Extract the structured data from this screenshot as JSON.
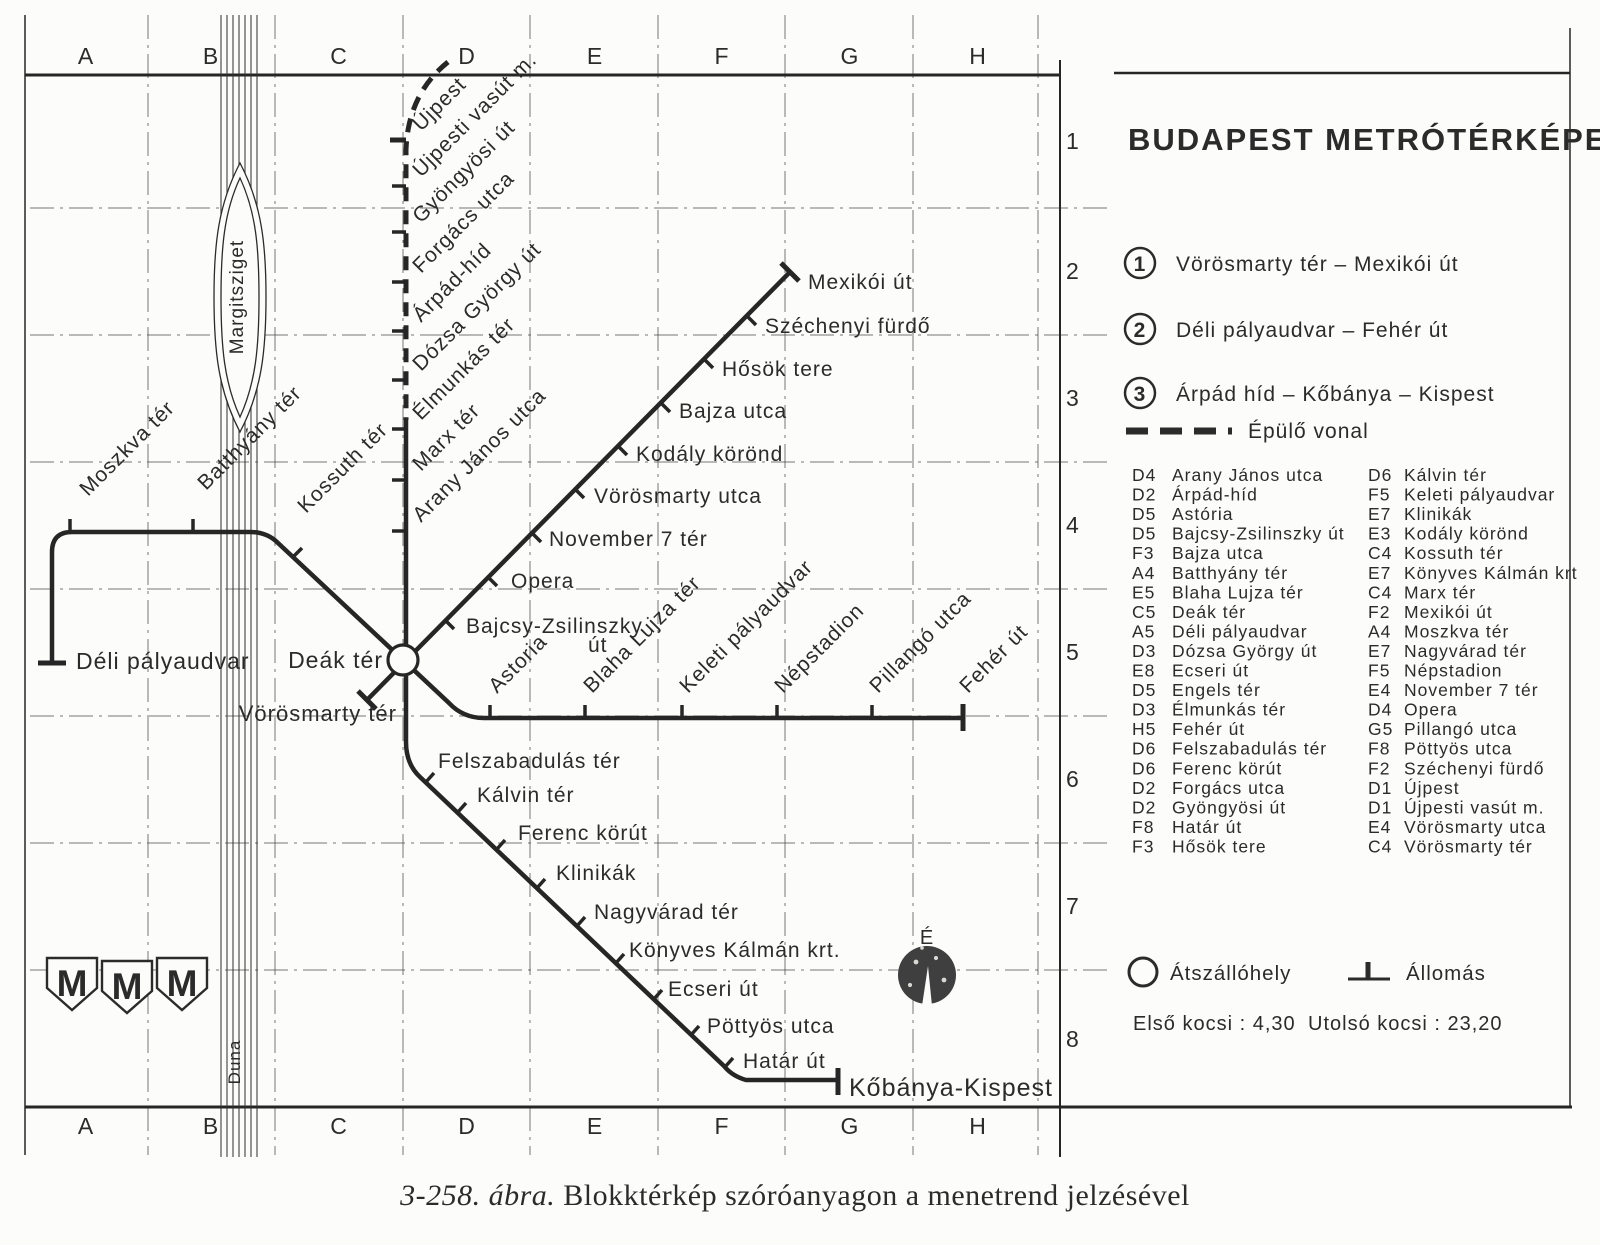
{
  "title": "BUDAPEST METRÓTÉRKÉPE",
  "caption": {
    "prefix": "3-258. ábra.",
    "rest": " Blokktérkép szóróanyagon a menetrend jelzésével"
  },
  "colors": {
    "ink": "#262626",
    "grid": "#4a4a4a",
    "paper": "#fcfcfa"
  },
  "labels": {
    "margitsziget": "Margitsziget",
    "duna": "Duna",
    "north": "É"
  },
  "logo": {
    "letter": "M"
  },
  "legend": {
    "lines": [
      {
        "num": "1",
        "label": "Vörösmarty tér – Mexikói út"
      },
      {
        "num": "2",
        "label": "Déli pályaudvar – Fehér út"
      },
      {
        "num": "3",
        "label": "Árpád híd – Kőbánya – Kispest"
      }
    ],
    "construction_label": "Épülő vonal",
    "interchange_label": "Átszállóhely",
    "station_label": "Állomás",
    "first_car": "Első kocsi : 4,30",
    "last_car": "Utolsó kocsi : 23,20"
  },
  "grid": {
    "cols": [
      {
        "l": "A",
        "x": 86
      },
      {
        "l": "B",
        "x": 211
      },
      {
        "l": "C",
        "x": 339
      },
      {
        "l": "D",
        "x": 467
      },
      {
        "l": "E",
        "x": 595
      },
      {
        "l": "F",
        "x": 722
      },
      {
        "l": "G",
        "x": 850
      },
      {
        "l": "H",
        "x": 978
      }
    ],
    "rows": [
      {
        "n": "1",
        "y": 149
      },
      {
        "n": "2",
        "y": 279
      },
      {
        "n": "3",
        "y": 406
      },
      {
        "n": "4",
        "y": 533
      },
      {
        "n": "5",
        "y": 660
      },
      {
        "n": "6",
        "y": 787
      },
      {
        "n": "7",
        "y": 914
      },
      {
        "n": "8",
        "y": 1047
      }
    ],
    "vlines": [
      148,
      275,
      403,
      530,
      658,
      785,
      913,
      1038
    ],
    "hlines": [
      208,
      335,
      462,
      589,
      716,
      843,
      970
    ],
    "top_letter_y": 64,
    "bottom_letter_y": 1134,
    "row_num_x": 1066
  },
  "frame": {
    "segments": [
      {
        "x1": 25,
        "y1": 75,
        "x2": 1060,
        "y2": 75,
        "w": 3
      },
      {
        "x1": 1114,
        "y1": 73,
        "x2": 1570,
        "y2": 73,
        "w": 2.5
      },
      {
        "x1": 25,
        "y1": 1107,
        "x2": 1572,
        "y2": 1107,
        "w": 3
      },
      {
        "x1": 25,
        "y1": 15,
        "x2": 25,
        "y2": 1155,
        "w": 1.5
      },
      {
        "x1": 1060,
        "y1": 60,
        "x2": 1060,
        "y2": 1157,
        "w": 2
      },
      {
        "x1": 1570,
        "y1": 28,
        "x2": 1570,
        "y2": 1107,
        "w": 1.5
      }
    ]
  },
  "river": {
    "xs": [
      221,
      227,
      233,
      239,
      245,
      251,
      257
    ],
    "y1": 15,
    "y2": 1157
  },
  "map": {
    "routes": [
      {
        "name": "line-3-under-construction",
        "d": "M 448 62 Q 408 94 406 150 L 406 420",
        "w": 5,
        "dash": "14 9"
      },
      {
        "name": "line-3",
        "d": "M 406 420 L 406 742 Q 406 764 420 777 L 724 1066 Q 732 1076 746 1080 L 838 1080",
        "w": 4.5
      },
      {
        "name": "line-2",
        "d": "M 52 662 L 52 552 Q 52 532 72 532 L 250 532 Q 267 532 278 543 L 449 703 Q 463 718 484 718 L 963 718",
        "w": 4.5
      },
      {
        "name": "line-1",
        "d": "M 367 700 L 790 272",
        "w": 4.5
      }
    ],
    "stations": [
      {
        "name": "Újpest",
        "lx": 421,
        "ly": 132,
        "rot": -45,
        "tick": [
          406,
          140,
          390,
          140
        ],
        "tw": 5
      },
      {
        "name": "Újpesti vasút m.",
        "lx": 421,
        "ly": 178,
        "rot": -45,
        "tick": [
          406,
          186,
          392,
          186
        ]
      },
      {
        "name": "Gyöngyösi út",
        "lx": 421,
        "ly": 224,
        "rot": -45,
        "tick": [
          406,
          232,
          392,
          232
        ]
      },
      {
        "name": "Forgács utca",
        "lx": 421,
        "ly": 274,
        "rot": -45,
        "tick": [
          406,
          282,
          392,
          282
        ]
      },
      {
        "name": "Árpád-híd",
        "lx": 421,
        "ly": 323,
        "rot": -45,
        "tick": [
          406,
          331,
          392,
          331
        ]
      },
      {
        "name": "Dózsa György út",
        "lx": 421,
        "ly": 372,
        "rot": -45,
        "tick": [
          406,
          380,
          392,
          380
        ]
      },
      {
        "name": "Élmunkás tér",
        "lx": 421,
        "ly": 421,
        "rot": -45,
        "tick": [
          406,
          429,
          392,
          429
        ]
      },
      {
        "name": "Marx tér",
        "lx": 421,
        "ly": 472,
        "rot": -45,
        "tick": [
          406,
          480,
          392,
          480
        ]
      },
      {
        "name": "Arany János utca",
        "lx": 421,
        "ly": 523,
        "rot": -45,
        "tick": [
          406,
          531,
          392,
          531
        ]
      },
      {
        "name": "Vörösmarty tér",
        "lx": 397,
        "ly": 721,
        "anchor": "end",
        "size": 22,
        "term": [
          358,
          691,
          376,
          709
        ]
      },
      {
        "name": "Bajcsy-Zsilinszky",
        "name2": "út",
        "l2x": 588,
        "l2y": 652,
        "lx": 466,
        "ly": 633,
        "tick": [
          446,
          621,
          454,
          629
        ]
      },
      {
        "name": "Opera",
        "lx": 511,
        "ly": 588,
        "tick": [
          489,
          578,
          497,
          586
        ]
      },
      {
        "name": "November 7 tér",
        "lx": 549,
        "ly": 546,
        "tick": [
          533,
          534,
          541,
          542
        ]
      },
      {
        "name": "Vörösmarty utca",
        "lx": 594,
        "ly": 503,
        "tick": [
          576,
          490,
          584,
          498
        ]
      },
      {
        "name": "Kodály körönd",
        "lx": 636,
        "ly": 461,
        "tick": [
          619,
          447,
          627,
          455
        ]
      },
      {
        "name": "Bajza utca",
        "lx": 679,
        "ly": 418,
        "tick": [
          662,
          404,
          670,
          412
        ]
      },
      {
        "name": "Hősök tere",
        "lx": 722,
        "ly": 376,
        "tick": [
          705,
          360,
          713,
          368
        ]
      },
      {
        "name": "Széchenyi fürdő",
        "lx": 765,
        "ly": 333,
        "tick": [
          748,
          317,
          756,
          325
        ]
      },
      {
        "name": "Mexikói út",
        "lx": 808,
        "ly": 289,
        "term": [
          781,
          263,
          799,
          281
        ]
      },
      {
        "name": "Déli pályaudvar",
        "lx": 76,
        "ly": 669,
        "size": 23,
        "term": [
          38,
          663,
          66,
          663
        ]
      },
      {
        "name": "Moszkva tér",
        "lx": 88,
        "ly": 497,
        "rot": -45,
        "tick": [
          70,
          532,
          70,
          519
        ]
      },
      {
        "name": "Batthyány tér",
        "lx": 206,
        "ly": 491,
        "rot": -45,
        "tick": [
          193,
          532,
          193,
          519
        ]
      },
      {
        "name": "Kossuth tér",
        "lx": 306,
        "ly": 514,
        "rot": -45,
        "tick": [
          293,
          557,
          302,
          548
        ]
      },
      {
        "name": "Deák tér",
        "lx": 383,
        "ly": 668,
        "anchor": "end",
        "size": 23,
        "inter": [
          403,
          660,
          15
        ]
      },
      {
        "name": "Astoria",
        "lx": 497,
        "ly": 694,
        "rot": -45,
        "tick": [
          490,
          718,
          490,
          705
        ]
      },
      {
        "name": "Blaha Lujza tér",
        "lx": 592,
        "ly": 694,
        "rot": -45,
        "tick": [
          585,
          718,
          585,
          705
        ]
      },
      {
        "name": "Keleti pályaudvar",
        "lx": 688,
        "ly": 694,
        "rot": -45,
        "tick": [
          682,
          718,
          682,
          705
        ]
      },
      {
        "name": "Népstadion",
        "lx": 783,
        "ly": 694,
        "rot": -45,
        "tick": [
          777,
          718,
          777,
          705
        ]
      },
      {
        "name": "Pillangó utca",
        "lx": 878,
        "ly": 694,
        "rot": -45,
        "tick": [
          872,
          718,
          872,
          705
        ]
      },
      {
        "name": "Fehér út",
        "lx": 968,
        "ly": 694,
        "rot": -45,
        "term": [
          963,
          704,
          963,
          731
        ]
      },
      {
        "name": "Felszabadulás tér",
        "lx": 438,
        "ly": 768,
        "tick": [
          426,
          782,
          434,
          773
        ]
      },
      {
        "name": "Kálvin tér",
        "lx": 477,
        "ly": 802,
        "tick": [
          458,
          812,
          466,
          803
        ]
      },
      {
        "name": "Ferenc körút",
        "lx": 518,
        "ly": 840,
        "tick": [
          497,
          849,
          505,
          840
        ]
      },
      {
        "name": "Klinikák",
        "lx": 556,
        "ly": 880,
        "tick": [
          537,
          888,
          545,
          879
        ]
      },
      {
        "name": "Nagyvárad tér",
        "lx": 594,
        "ly": 919,
        "tick": [
          577,
          926,
          585,
          917
        ]
      },
      {
        "name": "Könyves Kálmán krt.",
        "lx": 629,
        "ly": 957,
        "tick": [
          616,
          963,
          624,
          954
        ]
      },
      {
        "name": "Ecseri út",
        "lx": 668,
        "ly": 996,
        "tick": [
          654,
          999,
          662,
          990
        ]
      },
      {
        "name": "Pöttyös utca",
        "lx": 707,
        "ly": 1033,
        "tick": [
          691,
          1035,
          699,
          1026
        ]
      },
      {
        "name": "Határ út",
        "lx": 743,
        "ly": 1068,
        "tick": [
          725,
          1067,
          733,
          1058
        ]
      },
      {
        "name": "Kőbánya-Kispest",
        "lx": 849,
        "ly": 1096,
        "size": 25,
        "term": [
          838,
          1068,
          838,
          1095
        ]
      }
    ]
  },
  "index": {
    "left": [
      {
        "code": "D4",
        "name": "Arany János utca"
      },
      {
        "code": "D2",
        "name": "Árpád-híd"
      },
      {
        "code": "D5",
        "name": "Astória"
      },
      {
        "code": "D5",
        "name": "Bajcsy-Zsilinszky út"
      },
      {
        "code": "F3",
        "name": "Bajza utca"
      },
      {
        "code": "A4",
        "name": "Batthyány tér"
      },
      {
        "code": "E5",
        "name": "Blaha Lujza tér"
      },
      {
        "code": "C5",
        "name": "Deák tér"
      },
      {
        "code": "A5",
        "name": "Déli pályaudvar"
      },
      {
        "code": "D3",
        "name": "Dózsa György út"
      },
      {
        "code": "E8",
        "name": "Ecseri út"
      },
      {
        "code": "D5",
        "name": "Engels tér"
      },
      {
        "code": "D3",
        "name": "Élmunkás tér"
      },
      {
        "code": "H5",
        "name": "Fehér út"
      },
      {
        "code": "D6",
        "name": "Felszabadulás tér"
      },
      {
        "code": "D6",
        "name": "Ferenc körút"
      },
      {
        "code": "D2",
        "name": "Forgács utca"
      },
      {
        "code": "D2",
        "name": "Gyöngyösi út"
      },
      {
        "code": "F8",
        "name": "Határ út"
      },
      {
        "code": "F3",
        "name": "Hősök tere"
      }
    ],
    "right": [
      {
        "code": "D6",
        "name": "Kálvin tér"
      },
      {
        "code": "F5",
        "name": "Keleti pályaudvar"
      },
      {
        "code": "E7",
        "name": "Klinikák"
      },
      {
        "code": "E3",
        "name": "Kodály körönd"
      },
      {
        "code": "C4",
        "name": "Kossuth tér"
      },
      {
        "code": "E7",
        "name": "Könyves Kálmán krt"
      },
      {
        "code": "C4",
        "name": "Marx tér"
      },
      {
        "code": "F2",
        "name": "Mexikói út"
      },
      {
        "code": "A4",
        "name": "Moszkva tér"
      },
      {
        "code": "E7",
        "name": "Nagyvárad tér"
      },
      {
        "code": "F5",
        "name": "Népstadion"
      },
      {
        "code": "E4",
        "name": "November 7 tér"
      },
      {
        "code": "D4",
        "name": "Opera"
      },
      {
        "code": "G5",
        "name": "Pillangó utca"
      },
      {
        "code": "F8",
        "name": "Pöttyös utca"
      },
      {
        "code": "F2",
        "name": "Széchenyi fürdő"
      },
      {
        "code": "D1",
        "name": "Újpest"
      },
      {
        "code": "D1",
        "name": "Újpesti vasút m."
      },
      {
        "code": "E4",
        "name": "Vörösmarty utca"
      },
      {
        "code": "C4",
        "name": "Vörösmarty tér"
      }
    ],
    "left_code_x": 1132,
    "left_name_x": 1172,
    "right_code_x": 1368,
    "right_name_x": 1404,
    "start_y": 481,
    "step": 19.55,
    "font": 17.5
  }
}
